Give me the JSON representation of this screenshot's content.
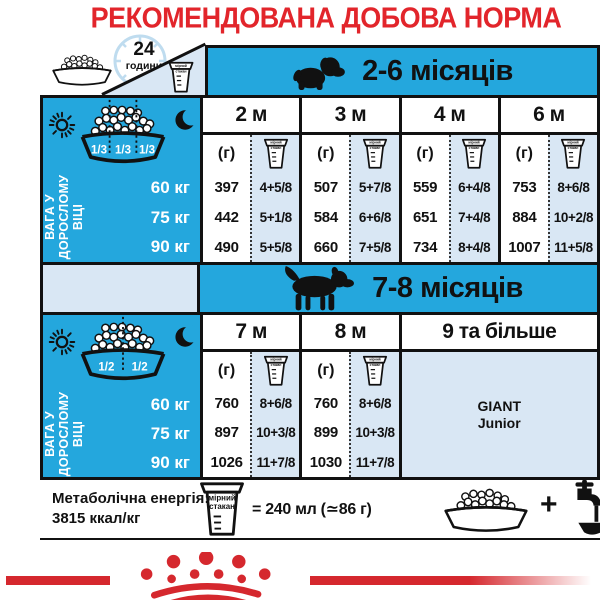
{
  "title": "РЕКОМЕНДОВАНА ДОБОВА НОРМА",
  "legend": {
    "hours_value": "24",
    "hours_unit": "години"
  },
  "cup_label": {
    "line1": "мірний",
    "line2": "стакан"
  },
  "grams_header": "(г)",
  "section1": {
    "title": "2-6 місяців",
    "portions": [
      "1/3",
      "1/3",
      "1/3"
    ],
    "weight_label": [
      "ВАГА У",
      "ДОРОСЛОМУ",
      "ВІЦІ"
    ],
    "weights": [
      "60 кг",
      "75 кг",
      "90 кг"
    ],
    "columns": [
      {
        "month": "2 м",
        "grams": [
          "397",
          "442",
          "490"
        ],
        "cups": [
          "4+5/8",
          "5+1/8",
          "5+5/8"
        ]
      },
      {
        "month": "3 м",
        "grams": [
          "507",
          "584",
          "660"
        ],
        "cups": [
          "5+7/8",
          "6+6/8",
          "7+5/8"
        ]
      },
      {
        "month": "4 м",
        "grams": [
          "559",
          "651",
          "734"
        ],
        "cups": [
          "6+4/8",
          "7+4/8",
          "8+4/8"
        ]
      },
      {
        "month": "6 м",
        "grams": [
          "753",
          "884",
          "1007"
        ],
        "cups": [
          "8+6/8",
          "10+2/8",
          "11+5/8"
        ]
      }
    ]
  },
  "section2": {
    "title": "7-8 місяців",
    "portions": [
      "1/2",
      "1/2"
    ],
    "weight_label": [
      "ВАГА У",
      "ДОРОСЛОМУ",
      "ВІЦІ"
    ],
    "weights": [
      "60 кг",
      "75 кг",
      "90 кг"
    ],
    "columns": [
      {
        "month": "7 м",
        "grams": [
          "760",
          "897",
          "1026"
        ],
        "cups": [
          "8+6/8",
          "10+3/8",
          "11+7/8"
        ]
      },
      {
        "month": "8 м",
        "grams": [
          "760",
          "899",
          "1030"
        ],
        "cups": [
          "8+6/8",
          "10+3/8",
          "11+7/8"
        ]
      }
    ],
    "more": {
      "header": "9 та більше",
      "product": [
        "GIANT",
        "Junior"
      ]
    }
  },
  "footer": {
    "energy_label": "Метаболічна енергія:",
    "energy_value": "3815 ккал/кг",
    "cup_equals": "= 240 мл (≃86 г)",
    "plus": "+"
  },
  "colors": {
    "blue": "#24A7DD",
    "light_blue": "#D9E7F4",
    "red": "#E2252B",
    "logo_red": "#D5282E"
  }
}
